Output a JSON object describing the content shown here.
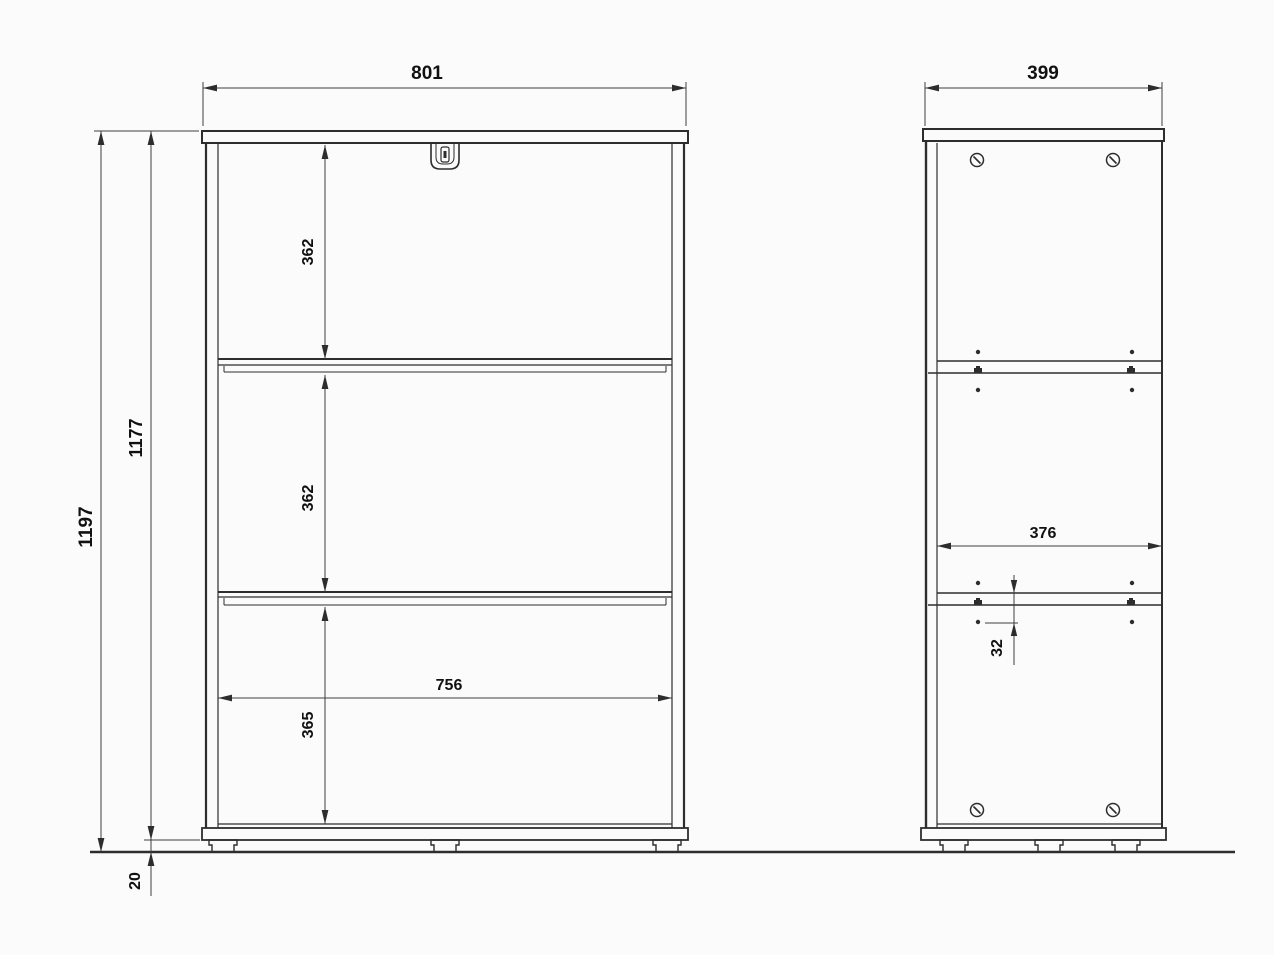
{
  "drawing": {
    "title": "cabinet-two-view-dimension-drawing",
    "front_view": {
      "overall_width": "801",
      "overall_height": "1197",
      "carcass_height": "1177",
      "foot_height": "20",
      "compartment_heights": [
        "362",
        "362",
        "365"
      ],
      "inner_width": "756"
    },
    "side_view": {
      "overall_depth": "399",
      "inner_depth": "376",
      "shelf_hole_offset": "32"
    },
    "colors": {
      "line": "#2d2d2d",
      "dimension_line": "#3f3f3f",
      "text": "#111111",
      "background": "#fbfbfb"
    }
  }
}
